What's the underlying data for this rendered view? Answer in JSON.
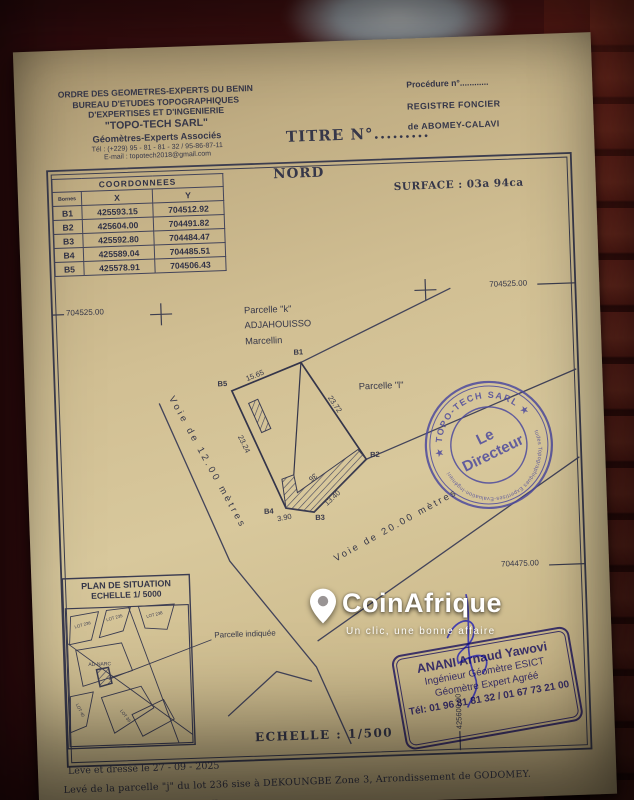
{
  "letterhead": {
    "l1": "ORDRE DES GEOMETRES-EXPERTS DU BENIN",
    "l2": "BUREAU D'ETUDES TOPOGRAPHIQUES",
    "l3": "D'EXPERTISES ET D'INGENIERIE",
    "l4": "\"TOPO-TECH SARL\"",
    "l5": "Géomètres-Experts Associés",
    "l6": "Tél : (+229) 95 - 81 - 81 - 32 / 95-86-87-11",
    "l7": "E-mail : topotech2018@gmail.com"
  },
  "registry": {
    "procedure": "Procédure n°............",
    "register": "REGISTRE FONCIER",
    "place": "de ABOMEY-CALAVI"
  },
  "title_no": "TITRE  N°.........",
  "plan": {
    "north": "NORD",
    "surface": "SURFACE : 03a  94ca",
    "grid": {
      "left_y": "704525.00",
      "right_y_top": "704525.00",
      "right_y_bottom": "704475.00",
      "bottom_x": "425600.00"
    },
    "coord_table": {
      "title": "COORDONNEES",
      "col_borne": "Bornes",
      "col_x": "X",
      "col_y": "Y",
      "rows": [
        {
          "id": "B1",
          "x": "425593.15",
          "y": "704512.92"
        },
        {
          "id": "B2",
          "x": "425604.00",
          "y": "704491.82"
        },
        {
          "id": "B3",
          "x": "425592.80",
          "y": "704484.47"
        },
        {
          "id": "B4",
          "x": "425589.04",
          "y": "704485.51"
        },
        {
          "id": "B5",
          "x": "425578.91",
          "y": "704506.43"
        }
      ]
    },
    "neighbors": {
      "k1": "Parcelle \"k\"",
      "k2": "ADJAHOUISSO",
      "k3": "Marcellin",
      "l": "Parcelle \"l\""
    },
    "vertices": {
      "b1": "B1",
      "b2": "B2",
      "b3": "B3",
      "b4": "B4",
      "b5": "B5"
    },
    "measures": {
      "b5_b1": "15.65",
      "b1_b2": "23.72",
      "b5_b4": "23.24",
      "b3_b2": "13.40",
      "b4_b3": "3.90",
      "hatch_label": "36"
    },
    "roads": {
      "road12": "Voie  de  12.00  mètres",
      "road20": "Voie  de  20.00  mètres"
    },
    "inset": {
      "title1": "PLAN DE SITUATION",
      "title2": "ECHELLE 1/ 5000",
      "pointer": "Parcelle indiquée",
      "lots": [
        "LOT 236",
        "LOT 235",
        "LOT 238",
        "AD-NARC",
        "LOT 40",
        "LOT 39"
      ]
    },
    "scale_label": "ECHELLE : 1/500"
  },
  "stamps": {
    "round": {
      "top": "★ TOPO-TECH SARL ★",
      "center1": "Le",
      "center2": "Directeur",
      "bottom": "Etudes Topographiques Expertises-Evaluation-Ingénierie"
    },
    "rect": {
      "l1": "ANANI Arnaud Yawovi",
      "l2": "Ingénieur Géomètre ESICT",
      "l3": "Géomètre Expert Agréé",
      "l4": "Tél: 01 96 81 81 32 / 01 67 73 21 00"
    }
  },
  "footer": {
    "date_line": "Levé et dressé  le 27 - 09 - 2025",
    "desc_line": "Levé de la parcelle \"j\" du lot 236 sise à DEKOUNGBE Zone 3, Arrondissement de GODOMEY.",
    "commune_line": "Commune de ABOMEY-CALAVI"
  },
  "watermark": {
    "brand": "CoinAfrique",
    "slogan": "Un clic, une bonne affaire"
  },
  "colors": {
    "paper": "#d1bf93",
    "ink": "#363749",
    "stamp_purple": "#4d4a9e",
    "stamp_blue": "#3d36b8",
    "brick": "#8e3428",
    "watermark": "#ffffff"
  }
}
